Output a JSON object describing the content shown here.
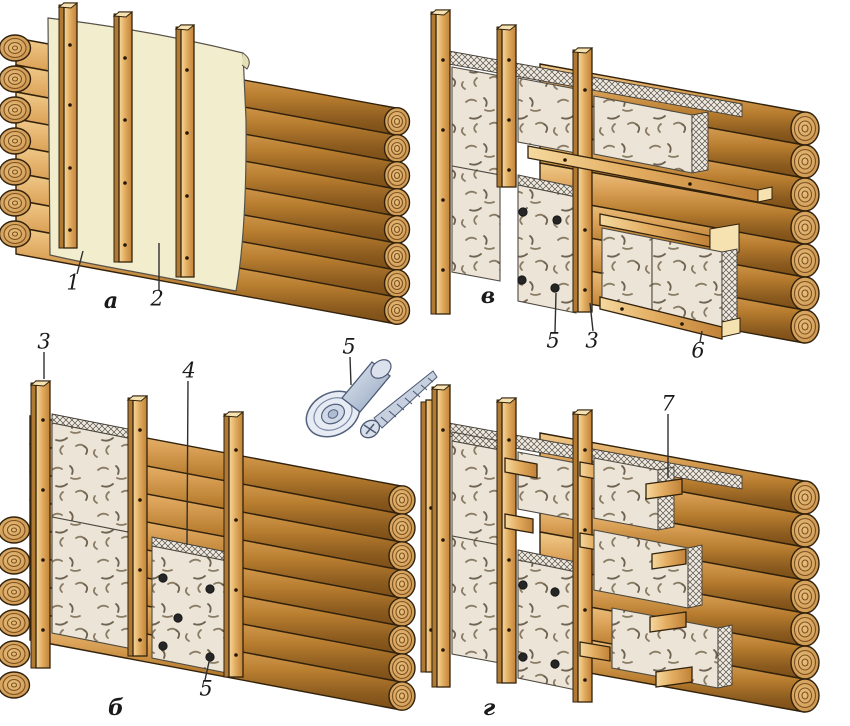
{
  "palette": {
    "background": "#ffffff",
    "log_wood_light": "#f1ca8a",
    "log_wood_mid": "#cf954a",
    "log_wood_dark": "#7c4e16",
    "log_outline": "#32220c",
    "batten_wood": "#e3ad61",
    "membrane_sheet": "#f2eecd",
    "insulation_board": "#ebe4d7",
    "cut_edge_hatch": "#57514a",
    "fastener_metal": "#b6c3d6",
    "fastener_dot": "#262626",
    "label_ink": "#1a1a1a"
  },
  "diagrams": {
    "a": {
      "letter": "а",
      "callouts": {
        "c1": "1",
        "c2": "2"
      }
    },
    "b": {
      "letter": "б",
      "callouts": {
        "c3": "3",
        "c4": "4",
        "c5": "5"
      }
    },
    "v": {
      "letter": "в",
      "callouts": {
        "c5": "5",
        "c3": "3",
        "c6": "6"
      }
    },
    "g": {
      "letter": "г",
      "callouts": {
        "c7": "7"
      }
    },
    "fastener": {
      "callouts": {
        "c5": "5"
      }
    }
  }
}
